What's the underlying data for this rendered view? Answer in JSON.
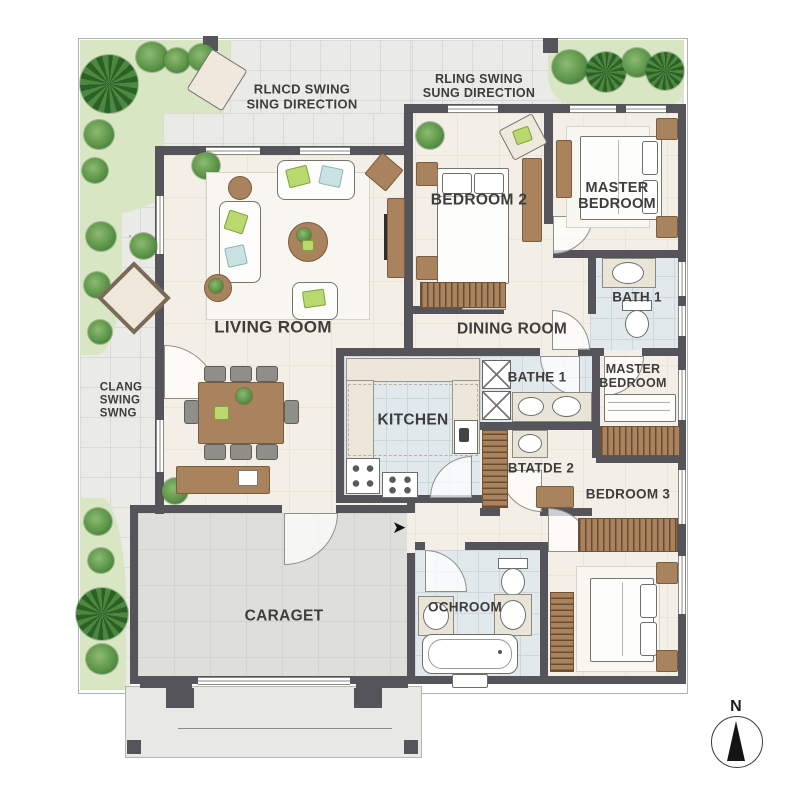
{
  "notes": {
    "top_left_line1": "RLNCD SWING",
    "top_left_line2": "SING DIRECTION",
    "top_right_line1": "RLING SWING",
    "top_right_line2": "SUNG DIRECTION",
    "left_line1": "CLANG",
    "left_line2": "SWING",
    "left_line3": "SWNG"
  },
  "rooms": {
    "living": "LIVING ROOM",
    "dining": "DINING ROOM",
    "kitchen": "KITCHEN",
    "bedroom2": "BEDROOM 2",
    "master_top_line1": "MASTER",
    "master_top_line2": "BEDROOM",
    "bath1": "BATH 1",
    "bathe1": "BATHE 1",
    "master_right_line1": "MASTER",
    "master_right_line2": "BEDROOM",
    "btatde2": "BTATDE 2",
    "bedroom3": "BEDROOM 3",
    "ochroom": "OCHROOM",
    "garage": "CARAGET"
  },
  "compass": {
    "label": "N"
  },
  "icons": {
    "entry_arrow": "➤"
  },
  "colors": {
    "wall": "#55545a",
    "floor_cream": "#f3efe6",
    "floor_tile": "#e2e9ec",
    "patio": "#eaeae6",
    "garage_floor": "#dededa",
    "garden": "#d9e6c4",
    "tree": "#5d9549",
    "wood": "#a9835d",
    "cushion_green": "#b9d86e",
    "cushion_blue": "#c9e2e2"
  }
}
